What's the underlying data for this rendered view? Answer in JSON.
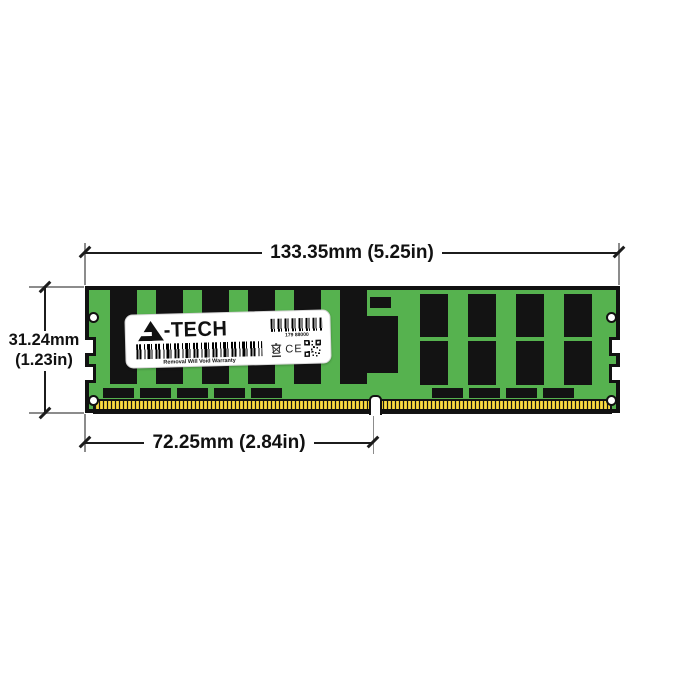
{
  "diagram": {
    "type": "memory-module-dimension-diagram",
    "dimensions": {
      "width": "133.35mm (5.25in)",
      "height_mm": "31.24mm",
      "height_in": "(1.23in)",
      "connector_width": "72.25mm (2.84in)"
    },
    "label": {
      "brand_rest": "-TECH",
      "serial": "179 88000",
      "warranty": "Removal Will Void Warranty",
      "ce": "CE"
    },
    "colors": {
      "pcb_green": "#56b24f",
      "chip_black": "#131313",
      "pin_gold": "#e7c62e",
      "dimension_line": "#1c1c1c",
      "extension_line": "#8c8c8c"
    },
    "module": {
      "left_chip_count": 6,
      "right_chip_count": 4,
      "bottom_left_pad_count": 5,
      "bottom_right_pad_count": 4
    }
  }
}
